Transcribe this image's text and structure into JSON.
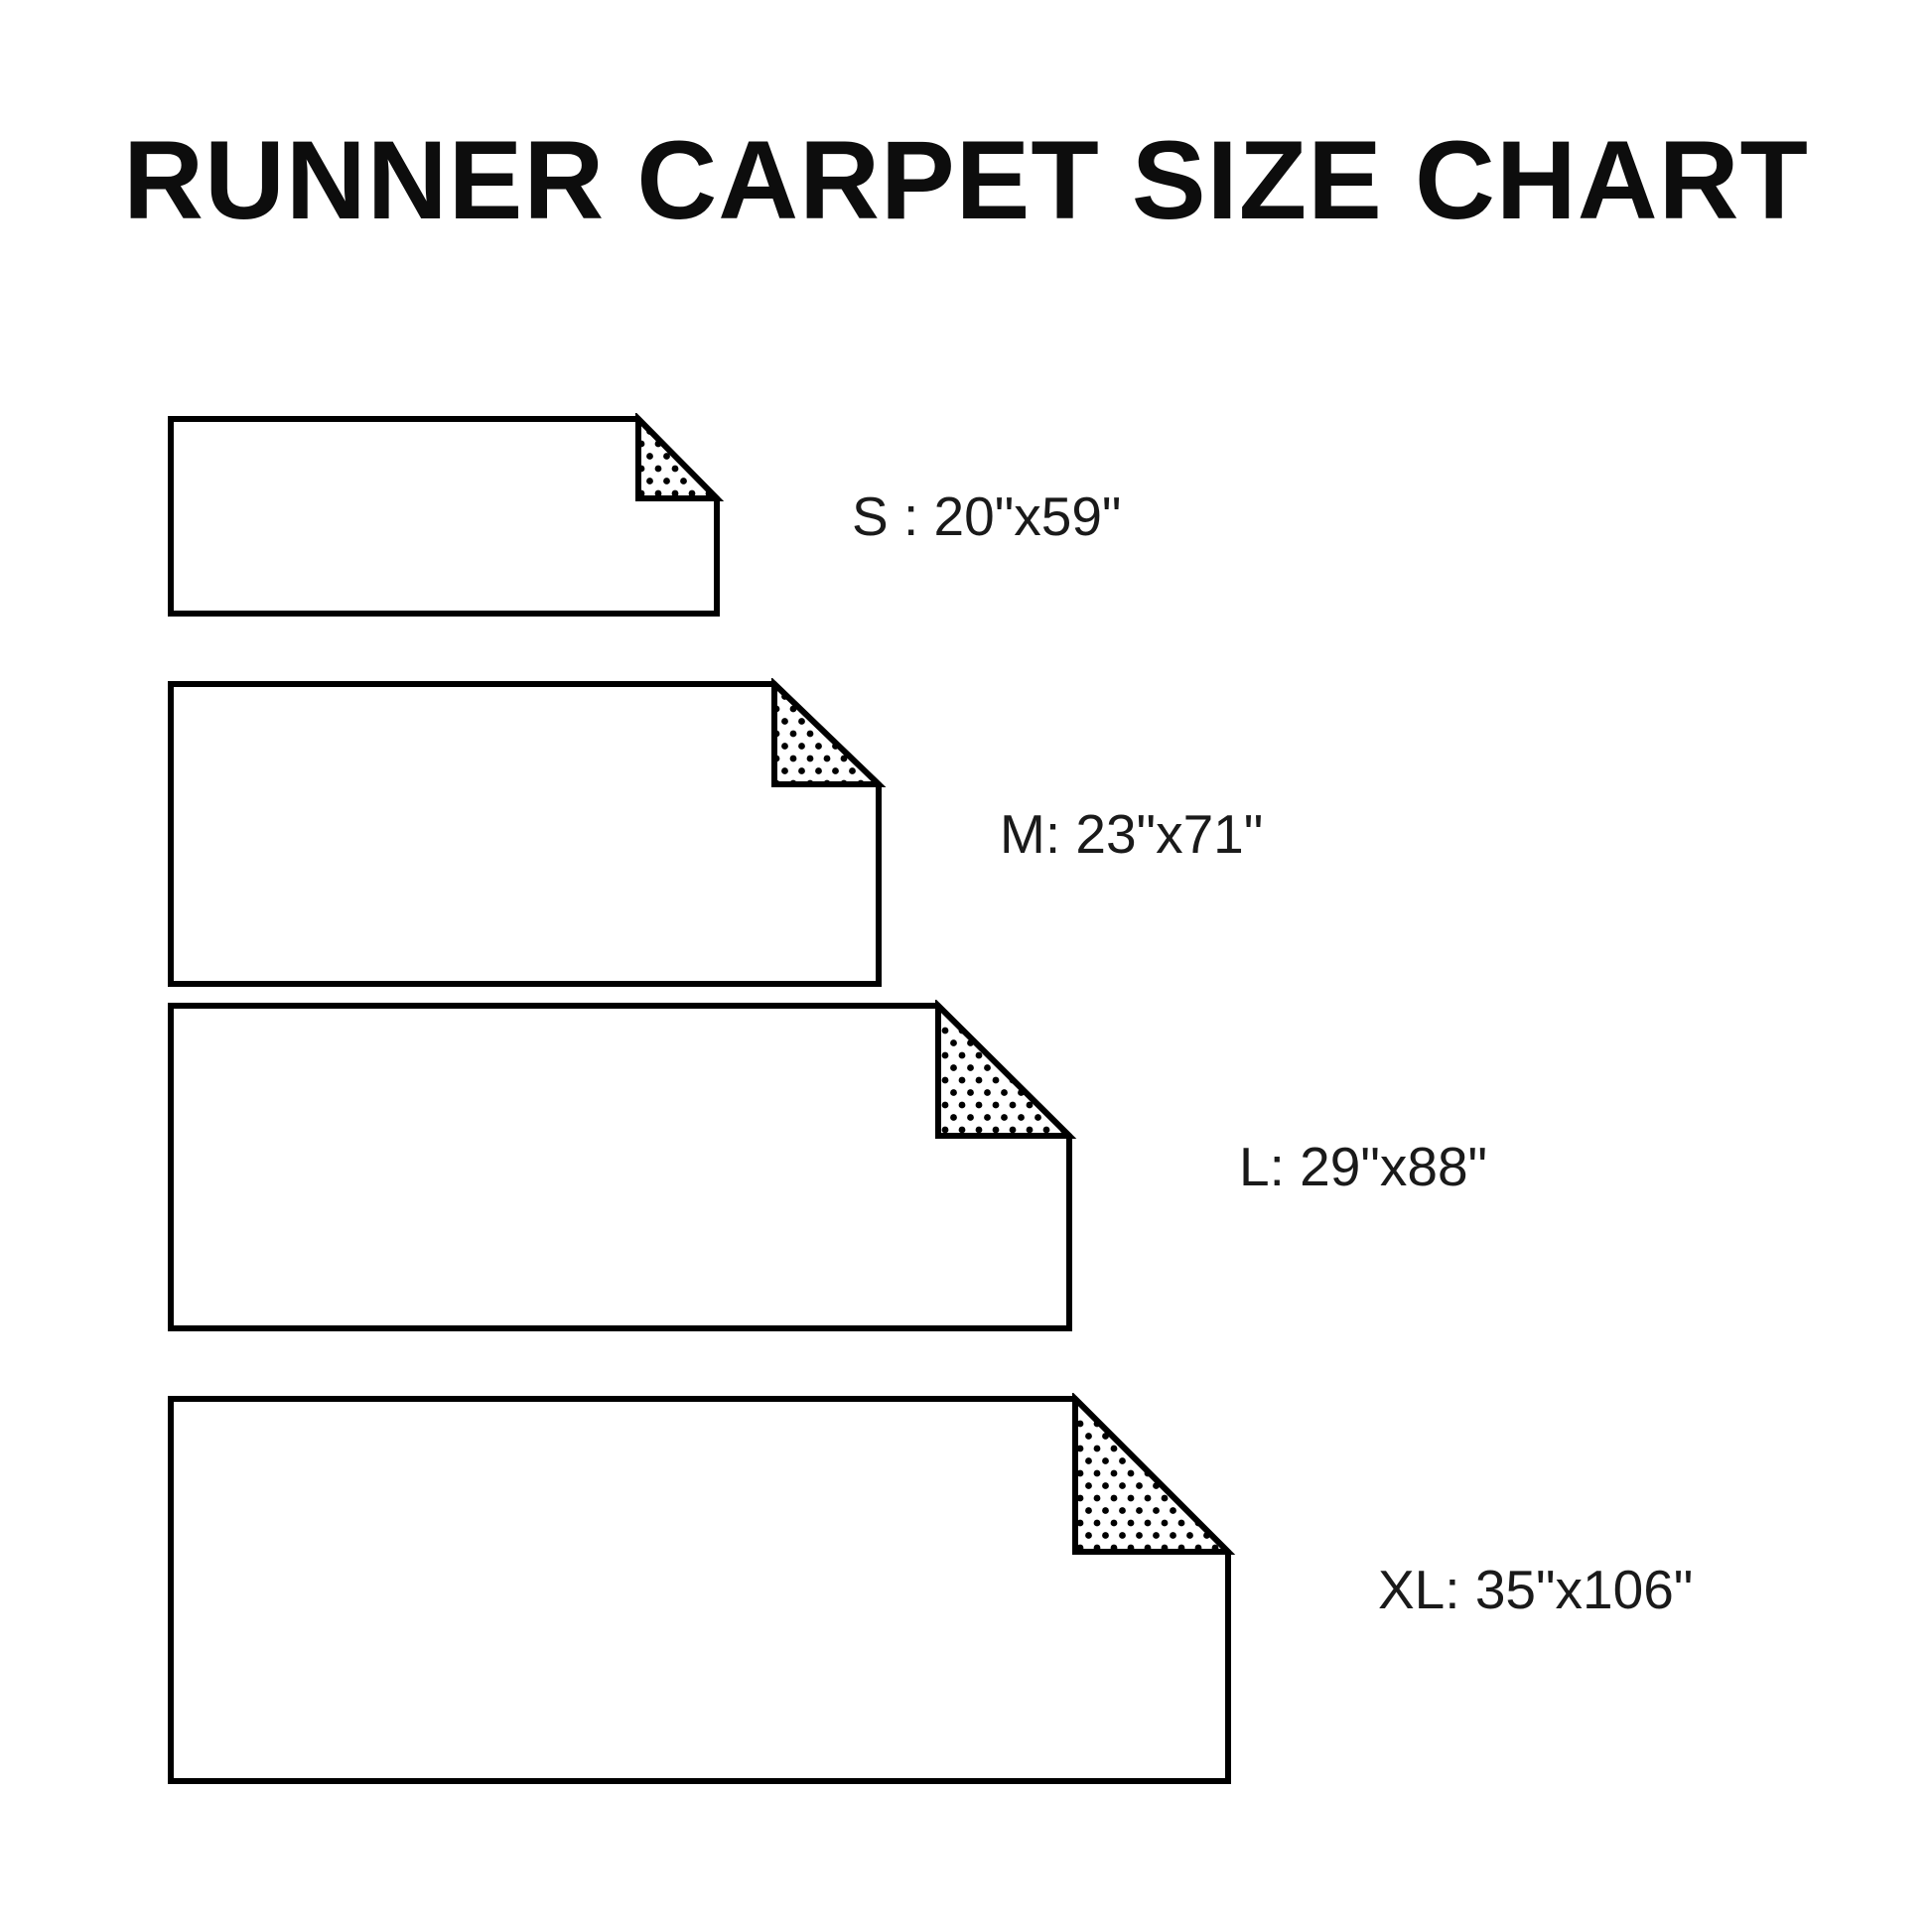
{
  "title": "RUNNER CARPET SIZE CHART",
  "sizes": [
    {
      "code": "S",
      "label": "S : 20\"x59\"",
      "width_in": "20\"",
      "length_in": "59\""
    },
    {
      "code": "M",
      "label": "M: 23\"x71\"",
      "width_in": "23\"",
      "length_in": "71\""
    },
    {
      "code": "L",
      "label": "L: 29\"x88\"",
      "width_in": "29\"",
      "length_in": "88\""
    },
    {
      "code": "XL",
      "label": "XL: 35\"x106\"",
      "width_in": "35\"",
      "length_in": "106\""
    }
  ],
  "colors": {
    "line": "#000000",
    "background": "#ffffff",
    "text": "#1a1a1a"
  }
}
